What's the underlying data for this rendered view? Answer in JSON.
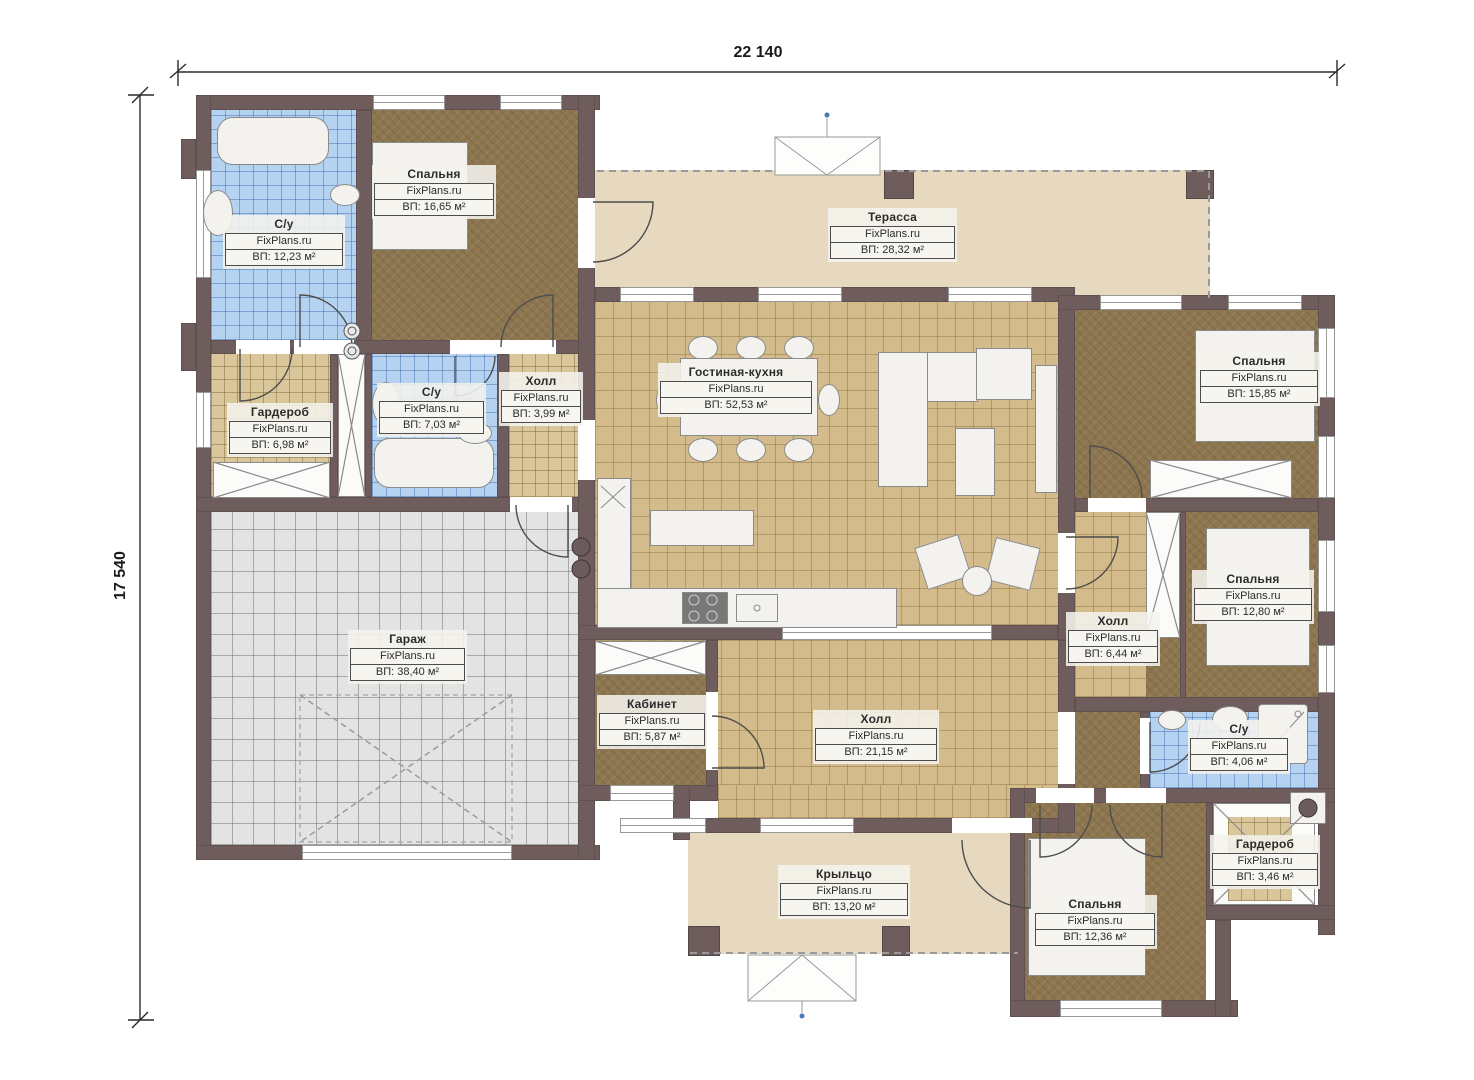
{
  "brand": "FixPlans.ru",
  "dimensions": {
    "width": "22 140",
    "height": "17 540"
  },
  "rooms": [
    {
      "id": "bathroom-1",
      "name": "С/у",
      "area": "ВП: 12,23 м²"
    },
    {
      "id": "bedroom-1",
      "name": "Спальня",
      "area": "ВП: 16,65 м²"
    },
    {
      "id": "terrace",
      "name": "Терасса",
      "area": "ВП: 28,32 м²"
    },
    {
      "id": "wardrobe-1",
      "name": "Гардероб",
      "area": "ВП: 6,98 м²"
    },
    {
      "id": "bathroom-2",
      "name": "С/у",
      "area": "ВП: 7,03 м²"
    },
    {
      "id": "hall-1",
      "name": "Холл",
      "area": "ВП: 3,99 м²"
    },
    {
      "id": "living-kitchen",
      "name": "Гостиная-кухня",
      "area": "ВП: 52,53 м²"
    },
    {
      "id": "bedroom-2",
      "name": "Спальня",
      "area": "ВП: 15,85 м²"
    },
    {
      "id": "bedroom-3",
      "name": "Спальня",
      "area": "ВП: 12,80 м²"
    },
    {
      "id": "hall-2",
      "name": "Холл",
      "area": "ВП: 6,44 м²"
    },
    {
      "id": "garage",
      "name": "Гараж",
      "area": "ВП: 38,40 м²"
    },
    {
      "id": "cabinet",
      "name": "Кабинет",
      "area": "ВП: 5,87 м²"
    },
    {
      "id": "hall-3",
      "name": "Холл",
      "area": "ВП: 21,15 м²"
    },
    {
      "id": "bathroom-3",
      "name": "С/у",
      "area": "ВП: 4,06 м²"
    },
    {
      "id": "wardrobe-2",
      "name": "Гардероб",
      "area": "ВП: 3,46 м²"
    },
    {
      "id": "porch",
      "name": "Крыльцо",
      "area": "ВП: 13,20 м²"
    },
    {
      "id": "bedroom-4",
      "name": "Спальня",
      "area": "ВП: 12,36 м²"
    }
  ],
  "colors": {
    "wall": "#6f5c5c",
    "floor_brown": "#8d764f",
    "floor_tan": "#d4bb8c",
    "floor_blue": "#b5d3f0",
    "floor_gray": "#e3e3e3",
    "floor_beige": "#e6d9c0"
  }
}
